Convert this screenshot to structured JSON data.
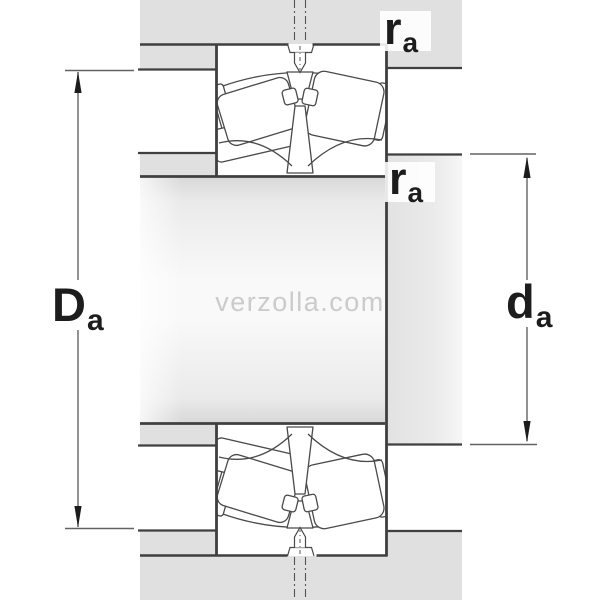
{
  "diagram": {
    "title": "bearing-abutment-cross-section",
    "watermark": {
      "text": "verzolla.com"
    },
    "labels": {
      "housing_shoulder_diameter": {
        "main": "D",
        "sub": "a"
      },
      "shaft_shoulder_diameter": {
        "main": "d",
        "sub": "a"
      },
      "fillet_radius_top": {
        "main": "r",
        "sub": "a"
      },
      "fillet_radius_mid": {
        "main": "r",
        "sub": "a"
      }
    },
    "colors": {
      "background": "#ffffff",
      "section_fill": "#e0e0e0",
      "outline": "#3f3f3f",
      "internal_line": "#4a4a4a",
      "dimension_line": "#636363",
      "arrow": "#1c1c1c",
      "label_text": "#1d1d1d",
      "watermark": "#cbcbcb"
    }
  }
}
